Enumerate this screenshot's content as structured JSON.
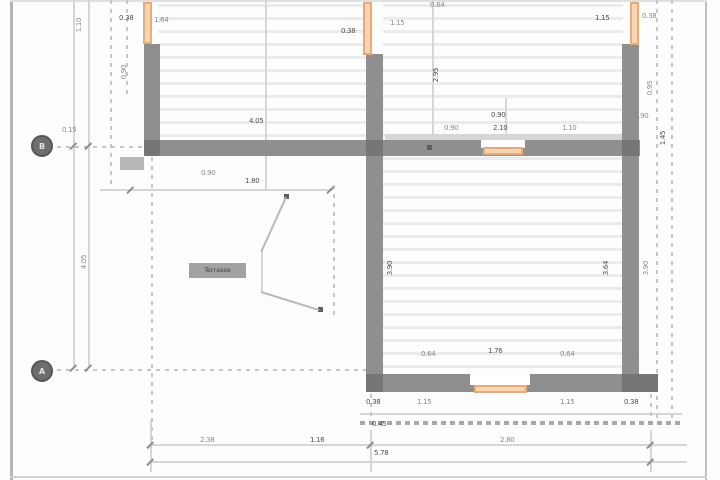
{
  "drawing": {
    "type": "architectural-floor-plan",
    "colors": {
      "wall": "#8f8f8f",
      "wall_accent": "#767676",
      "window": "#e8a97b",
      "window_inner": "#f5d5b2",
      "hatch": "#ebebee",
      "dim_line": "#d6d6d6",
      "dim_text": "#8a8a8a",
      "dim_text_dark": "#4f4f4f"
    }
  },
  "axes": [
    {
      "label": "B"
    },
    {
      "label": "A"
    }
  ],
  "leader": {
    "label": "Terrasse"
  },
  "plan": {
    "walls": [
      {
        "x": 144,
        "y": 44,
        "w": 16,
        "h": 112
      },
      {
        "x": 366,
        "y": 54,
        "w": 17,
        "h": 338
      },
      {
        "x": 622,
        "y": 44,
        "w": 17,
        "h": 348
      },
      {
        "x": 144,
        "y": 140,
        "w": 496,
        "h": 16
      },
      {
        "x": 366,
        "y": 374,
        "w": 292,
        "h": 18
      }
    ],
    "accents": [
      {
        "x": 144,
        "y": 140,
        "w": 16,
        "h": 16
      },
      {
        "x": 366,
        "y": 140,
        "w": 17,
        "h": 16
      },
      {
        "x": 622,
        "y": 140,
        "w": 17,
        "h": 16
      },
      {
        "x": 366,
        "y": 374,
        "w": 17,
        "h": 18
      },
      {
        "x": 622,
        "y": 374,
        "w": 36,
        "h": 18
      }
    ],
    "openings": [
      {
        "x": 481,
        "y": 140,
        "w": 44,
        "h": 8
      },
      {
        "x": 470,
        "y": 374,
        "w": 60,
        "h": 11
      }
    ],
    "windows": [
      {
        "x": 143,
        "y": 2,
        "w": 9,
        "h": 42
      },
      {
        "x": 363,
        "y": 2,
        "w": 9,
        "h": 53
      },
      {
        "x": 630,
        "y": 2,
        "w": 9,
        "h": 43
      },
      {
        "x": 483,
        "y": 147,
        "w": 40,
        "h": 8
      },
      {
        "x": 474,
        "y": 385,
        "w": 53,
        "h": 8
      }
    ],
    "hatch_regions": [
      {
        "x": 158,
        "y": 4,
        "w": 208,
        "h": 137
      },
      {
        "x": 383,
        "y": 4,
        "w": 240,
        "h": 137
      },
      {
        "x": 383,
        "y": 157,
        "w": 240,
        "h": 218
      }
    ],
    "solid_lines": [
      {
        "x": 73,
        "y": 0,
        "w": 2,
        "h": 368
      },
      {
        "x": 88,
        "y": 0,
        "w": 2,
        "h": 368
      },
      {
        "x": 100,
        "y": 189,
        "w": 233,
        "h": 2
      },
      {
        "x": 150,
        "y": 444,
        "w": 537,
        "h": 2
      },
      {
        "x": 150,
        "y": 461,
        "w": 537,
        "h": 2
      },
      {
        "x": 360,
        "y": 413,
        "w": 322,
        "h": 2
      },
      {
        "x": 150,
        "y": 420,
        "w": 2,
        "h": 52
      },
      {
        "x": 370,
        "y": 430,
        "w": 2,
        "h": 42
      },
      {
        "x": 650,
        "y": 430,
        "w": 2,
        "h": 42
      },
      {
        "x": 265,
        "y": 0,
        "w": 2,
        "h": 190
      },
      {
        "x": 432,
        "y": 0,
        "w": 2,
        "h": 140
      },
      {
        "x": 505,
        "y": 98,
        "w": 2,
        "h": 58
      },
      {
        "x": 385,
        "y": 134,
        "w": 237,
        "h": 6
      },
      {
        "x": 261,
        "y": 248,
        "w": 2,
        "h": 45
      }
    ],
    "dashed_lines": [
      {
        "dir": "v",
        "x": 110,
        "y": 0,
        "len": 190
      },
      {
        "dir": "v",
        "x": 126,
        "y": 0,
        "len": 95
      },
      {
        "dir": "v",
        "x": 151,
        "y": 157,
        "len": 285
      },
      {
        "dir": "v",
        "x": 333,
        "y": 185,
        "len": 130
      },
      {
        "dir": "v",
        "x": 370,
        "y": 394,
        "len": 36
      },
      {
        "dir": "v",
        "x": 650,
        "y": 394,
        "len": 36
      },
      {
        "dir": "v",
        "x": 656,
        "y": 0,
        "len": 418
      },
      {
        "dir": "v",
        "x": 671,
        "y": 0,
        "len": 418
      },
      {
        "dir": "h",
        "x": 57,
        "y": 146,
        "len": 87
      },
      {
        "dir": "h",
        "x": 57,
        "y": 369,
        "len": 310
      },
      {
        "dir": "h",
        "x": 360,
        "y": 421,
        "len": 320,
        "style": "dense"
      }
    ],
    "ticks": [
      {
        "x": 73,
        "y": 146
      },
      {
        "x": 88,
        "y": 146
      },
      {
        "x": 73,
        "y": 368
      },
      {
        "x": 88,
        "y": 368
      },
      {
        "x": 150,
        "y": 445
      },
      {
        "x": 370,
        "y": 445
      },
      {
        "x": 650,
        "y": 445
      },
      {
        "x": 150,
        "y": 462
      },
      {
        "x": 650,
        "y": 462
      },
      {
        "x": 130,
        "y": 190
      },
      {
        "x": 330,
        "y": 190
      }
    ],
    "dots": [
      {
        "x": 284,
        "y": 194
      },
      {
        "x": 318,
        "y": 307
      },
      {
        "x": 427,
        "y": 145
      }
    ],
    "labels": [
      {
        "t": "0.38",
        "x": 119,
        "y": 14,
        "d": 1
      },
      {
        "t": "1.64",
        "x": 154,
        "y": 16
      },
      {
        "t": "0.38",
        "x": 341,
        "y": 27,
        "d": 1
      },
      {
        "t": "1.15",
        "x": 390,
        "y": 19
      },
      {
        "t": "0.64",
        "x": 430,
        "y": 1
      },
      {
        "t": "1.15",
        "x": 595,
        "y": 14,
        "d": 1
      },
      {
        "t": "0.38",
        "x": 642,
        "y": 12
      },
      {
        "t": "0.15",
        "x": 62,
        "y": 126
      },
      {
        "t": "1.10",
        "x": 79,
        "y": 25,
        "r": 1
      },
      {
        "t": "4.05",
        "x": 84,
        "y": 262,
        "r": 1
      },
      {
        "t": "0.90",
        "x": 124,
        "y": 72,
        "r": 1
      },
      {
        "t": "2.95",
        "x": 436,
        "y": 75,
        "r": 1,
        "d": 1
      },
      {
        "t": "0.95",
        "x": 650,
        "y": 88,
        "r": 1
      },
      {
        "t": "1.45",
        "x": 663,
        "y": 138,
        "r": 1,
        "d": 1
      },
      {
        "t": "3.90",
        "x": 646,
        "y": 268,
        "r": 1
      },
      {
        "t": "3.90",
        "x": 390,
        "y": 268,
        "r": 1,
        "d": 1
      },
      {
        "t": "3.64",
        "x": 606,
        "y": 268,
        "r": 1,
        "d": 1
      },
      {
        "t": "4.05",
        "x": 249,
        "y": 117,
        "d": 1
      },
      {
        "t": "0.90",
        "x": 201,
        "y": 169
      },
      {
        "t": "1.80",
        "x": 245,
        "y": 177,
        "d": 1
      },
      {
        "t": "0.90",
        "x": 444,
        "y": 124
      },
      {
        "t": "0.90",
        "x": 491,
        "y": 111,
        "d": 1
      },
      {
        "t": "2.10",
        "x": 493,
        "y": 124,
        "d": 1
      },
      {
        "t": "1.10",
        "x": 562,
        "y": 124
      },
      {
        "t": "0.90",
        "x": 634,
        "y": 112
      },
      {
        "t": "0.64",
        "x": 421,
        "y": 350
      },
      {
        "t": "1.76",
        "x": 488,
        "y": 347,
        "d": 1
      },
      {
        "t": "0.64",
        "x": 560,
        "y": 350
      },
      {
        "t": "0.38",
        "x": 623,
        "y": 350
      },
      {
        "t": "1.15",
        "x": 417,
        "y": 398
      },
      {
        "t": "1.15",
        "x": 560,
        "y": 398
      },
      {
        "t": "0.38",
        "x": 624,
        "y": 398,
        "d": 1
      },
      {
        "t": "0.38",
        "x": 366,
        "y": 398,
        "d": 1
      },
      {
        "t": "0.45",
        "x": 372,
        "y": 420,
        "d": 1
      },
      {
        "t": "2.38",
        "x": 200,
        "y": 436
      },
      {
        "t": "1.16",
        "x": 310,
        "y": 436,
        "d": 1
      },
      {
        "t": "2.80",
        "x": 500,
        "y": 436
      },
      {
        "t": "5.78",
        "x": 374,
        "y": 449,
        "d": 1
      }
    ]
  }
}
